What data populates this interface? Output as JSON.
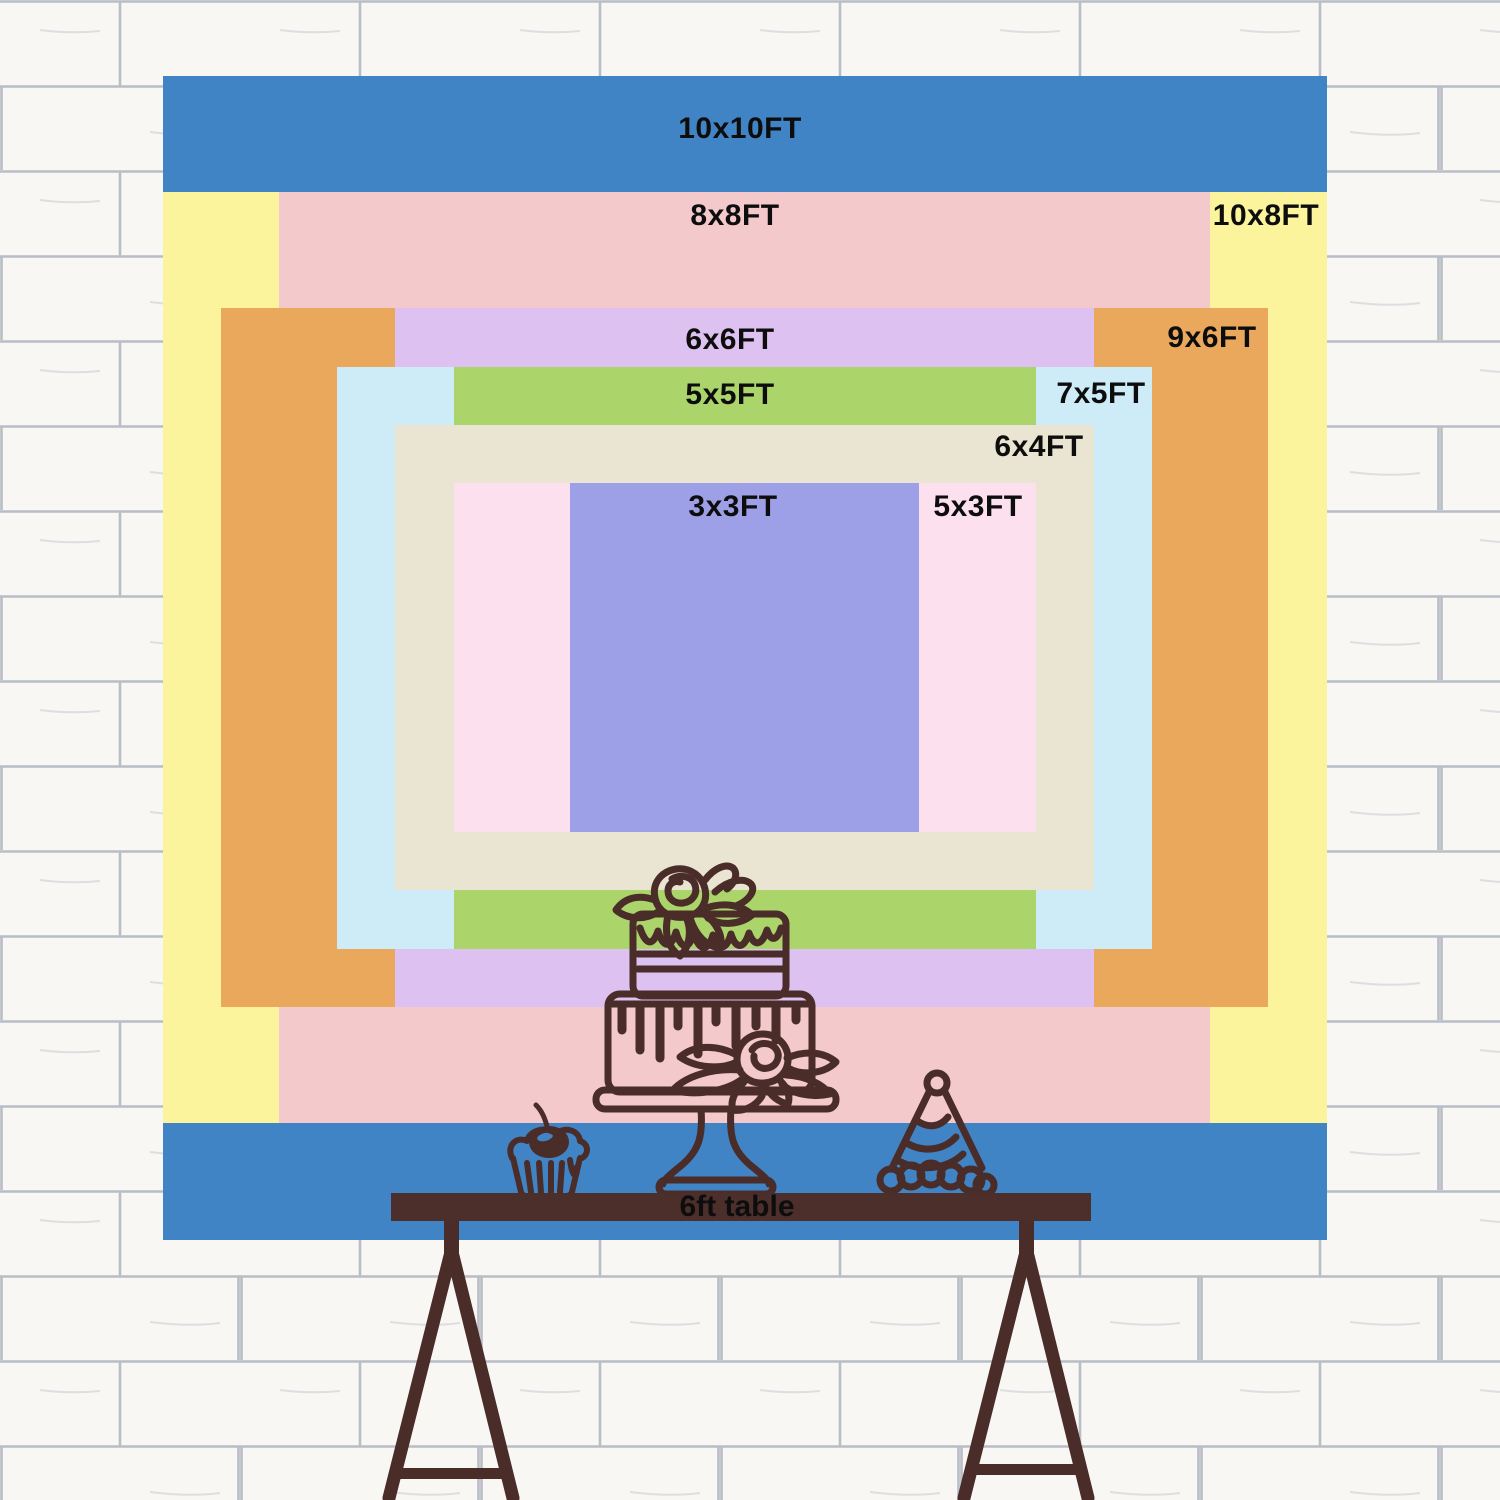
{
  "backdrop": {
    "sizes": [
      {
        "label": "10x10FT",
        "color": "#4184c5",
        "w_ft": 10,
        "h_ft": 10,
        "label_px": {
          "x": 740,
          "y": 129
        }
      },
      {
        "label": "10x8FT",
        "color": "#fcf49d",
        "w_ft": 10,
        "h_ft": 8,
        "label_px": {
          "x": 1266,
          "y": 216
        }
      },
      {
        "label": "8x8FT",
        "color": "#f3c9cc",
        "w_ft": 8,
        "h_ft": 8,
        "label_px": {
          "x": 735,
          "y": 216
        }
      },
      {
        "label": "9x6FT",
        "color": "#eaa85d",
        "w_ft": 9,
        "h_ft": 6,
        "label_px": {
          "x": 1212,
          "y": 338
        }
      },
      {
        "label": "6x6FT",
        "color": "#ddc1f0",
        "w_ft": 6,
        "h_ft": 6,
        "label_px": {
          "x": 730,
          "y": 340
        }
      },
      {
        "label": "7x5FT",
        "color": "#cdecf8",
        "w_ft": 7,
        "h_ft": 5,
        "label_px": {
          "x": 1101,
          "y": 394
        }
      },
      {
        "label": "5x5FT",
        "color": "#abd56a",
        "w_ft": 5,
        "h_ft": 5,
        "label_px": {
          "x": 730,
          "y": 395
        }
      },
      {
        "label": "6x4FT",
        "color": "#eae4d3",
        "w_ft": 6,
        "h_ft": 4,
        "label_px": {
          "x": 1039,
          "y": 447
        }
      },
      {
        "label": "5x3FT",
        "color": "#fde0ee",
        "w_ft": 5,
        "h_ft": 3,
        "label_px": {
          "x": 978,
          "y": 507
        }
      },
      {
        "label": "3x3FT",
        "color": "#9da0e6",
        "w_ft": 3,
        "h_ft": 3,
        "label_px": {
          "x": 733,
          "y": 507
        }
      }
    ],
    "layout": {
      "center_x": 744.5,
      "center_y": 657.5,
      "px_per_ft": 116.4
    }
  },
  "table": {
    "label": "6ft table",
    "bar_color": "#4c2e2b",
    "text_color": "#0d0d0d"
  },
  "illustrations": {
    "stroke_color": "#4a2c29",
    "cake": "two-tier-rose-cake-on-stand",
    "cupcake": "cherry-cupcake",
    "party_hat": "striped-party-hat"
  },
  "wall": {
    "background": "#f8f7f4",
    "mortar_color": "#bcc0c8"
  },
  "label_text_color": "#0d0d0d"
}
